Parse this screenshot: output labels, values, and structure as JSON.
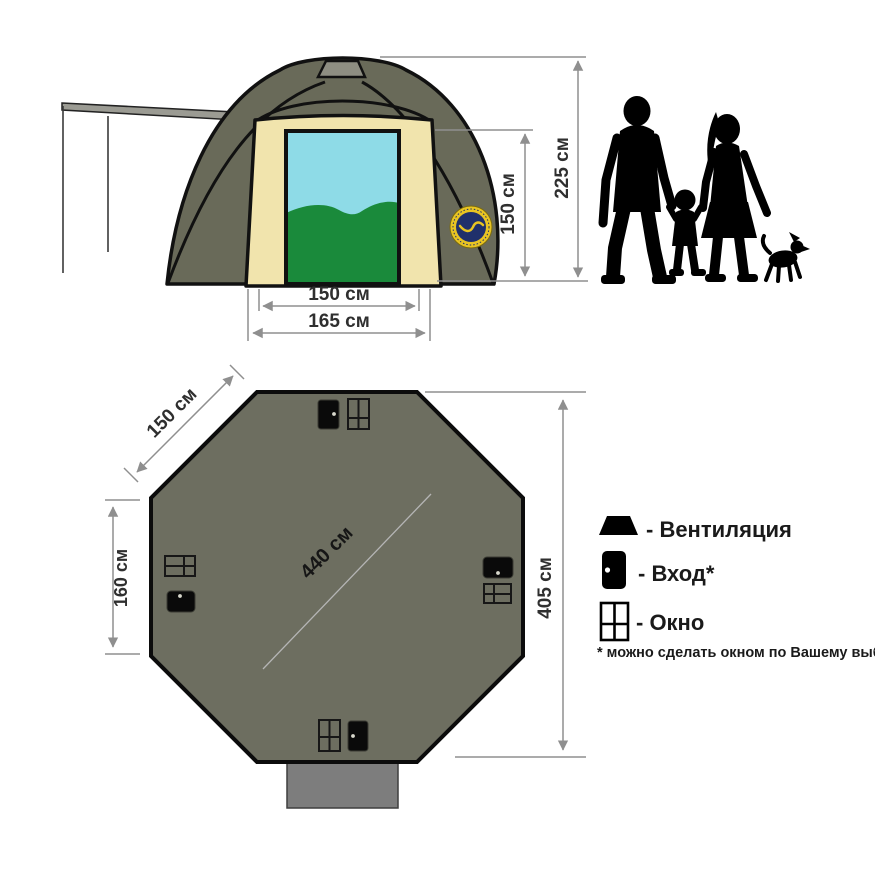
{
  "front_view": {
    "height_total": "225 см",
    "door_height": "150 см",
    "door_width": "150 см",
    "base_width": "165 см"
  },
  "floor_plan": {
    "side_length": "150 см",
    "left_side": "160 см",
    "diagonal": "440 см",
    "overall_width": "405 см"
  },
  "legend": {
    "items": [
      {
        "icon": "vent-icon",
        "label": "- Вентиляция"
      },
      {
        "icon": "door-icon",
        "label": "- Вход*"
      },
      {
        "icon": "window-icon",
        "label": "- Окно"
      }
    ],
    "footnote": "* можно сделать окном по Вашему выбору"
  },
  "colors": {
    "tent_fabric": "#696a59",
    "panel": "#f1e4ad",
    "sky": "#8edbe7",
    "grass": "#1a8a3b",
    "vent": "#8e8e82",
    "canopy": "#9b9b93",
    "badge_ring": "#e8c422",
    "badge_center": "#20306b",
    "plan_fill": "#6d6e60",
    "vestibule": "#7d7d7d",
    "dim_line": "#8f8f8f",
    "dim_text": "#2f2f2f",
    "legend_text": "#1a1a1a",
    "silhouette": "#000000"
  }
}
